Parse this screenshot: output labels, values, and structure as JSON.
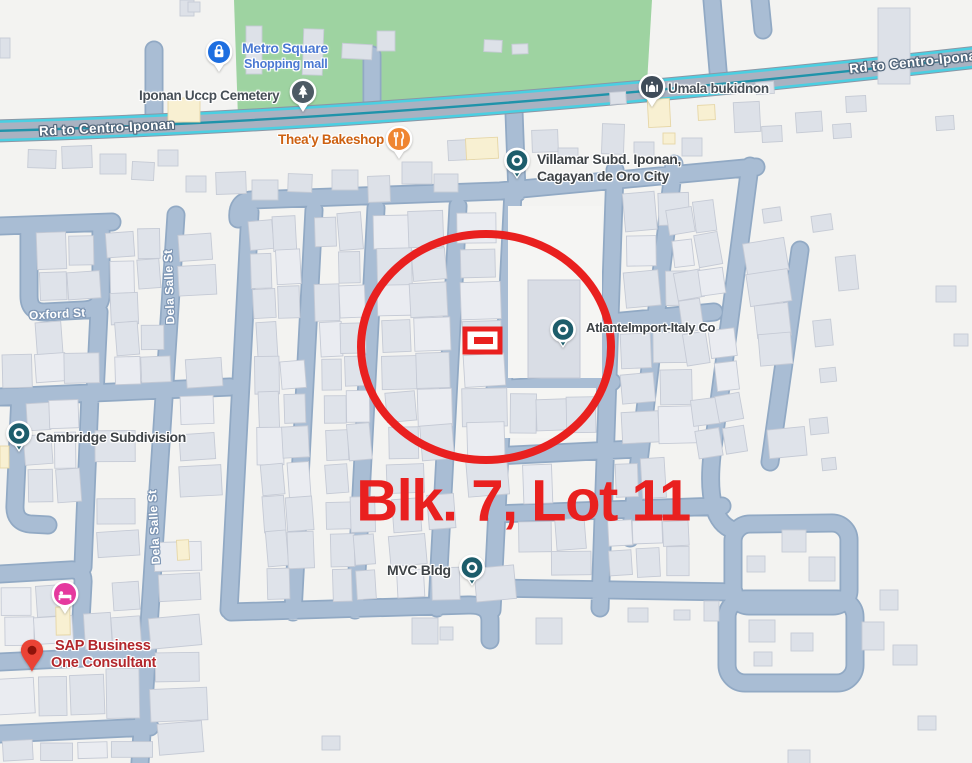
{
  "map": {
    "annotation": {
      "label": "Blk. 7, Lot 11"
    },
    "road_labels": {
      "trunk_left": "Rd to Centro-Iponan",
      "trunk_right": "Rd to Centro-Iponan",
      "oxford": "Oxford St",
      "dela_salle_upper": "Dela Salle St",
      "dela_salle_lower": "Dela Salle St"
    },
    "pois": {
      "metro_square": {
        "title": "Metro Square",
        "subtitle": "Shopping mall",
        "icon": "shopping-bag-icon"
      },
      "cemetery": {
        "title": "Iponan Uccp Cemetery",
        "icon": "cemetery-icon"
      },
      "bakeshop": {
        "title": "Thea'y Bakeshop",
        "icon": "restaurant-icon"
      },
      "umala": {
        "title": "Umala bukidnon",
        "icon": "place-of-worship-icon"
      },
      "villamar": {
        "line1": "Villamar Subd. Iponan,",
        "line2": "Cagayan de Oro City",
        "icon": "place-dot-icon"
      },
      "cambridge": {
        "title": "Cambridge Subdivision",
        "icon": "place-dot-icon"
      },
      "atlante": {
        "title": "AtlanteImport-Italy Co",
        "icon": "place-dot-icon"
      },
      "mvc": {
        "title": "MVC Bldg",
        "icon": "place-dot-icon"
      },
      "lodging": {
        "icon": "bed-icon"
      },
      "sap": {
        "line1": "SAP Business",
        "line2": "One Consultant",
        "icon": "red-map-pin-icon"
      }
    },
    "colors": {
      "annotation_red": "#e9201f",
      "road_fill": "#a9bdd4",
      "trunk_teal": "#4acfe2",
      "park_green": "#9ed3a1",
      "land": "#f3f3f1",
      "building_gray": "#dfe3ea",
      "poi_pin_teal": "#1d5d6b",
      "shopping_blue": "#1d6ee0",
      "food_orange": "#ef8531",
      "lodging_pink": "#e5399e",
      "sap_pin_red": "#EA4335",
      "sap_text_red": "#b2262b"
    }
  }
}
